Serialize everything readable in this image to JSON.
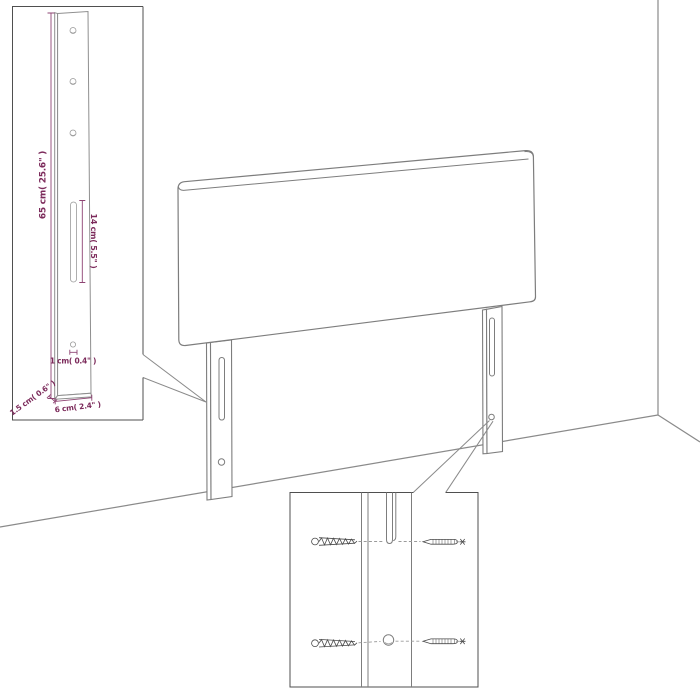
{
  "diagram": {
    "title": "Headboard wall-mount assembly diagram",
    "dimensions": {
      "leg_height": "65 cm( 25.6\" )",
      "slot_length": "14 cm( 5.5\" )",
      "hole_diameter": "1 cm( 0.4\" )",
      "leg_thickness": "1.5 cm( 0.6\" )",
      "leg_width": "6 cm( 2.4\" )"
    },
    "colors": {
      "outline_gray": "#7d7d7d",
      "wall_gray": "#8a8a8a",
      "inset_border": "#4f4f4f",
      "dimension_text": "#7c2b5b",
      "dimension_line": "#8e4473",
      "screw_gray": "#4a4a4a"
    }
  }
}
